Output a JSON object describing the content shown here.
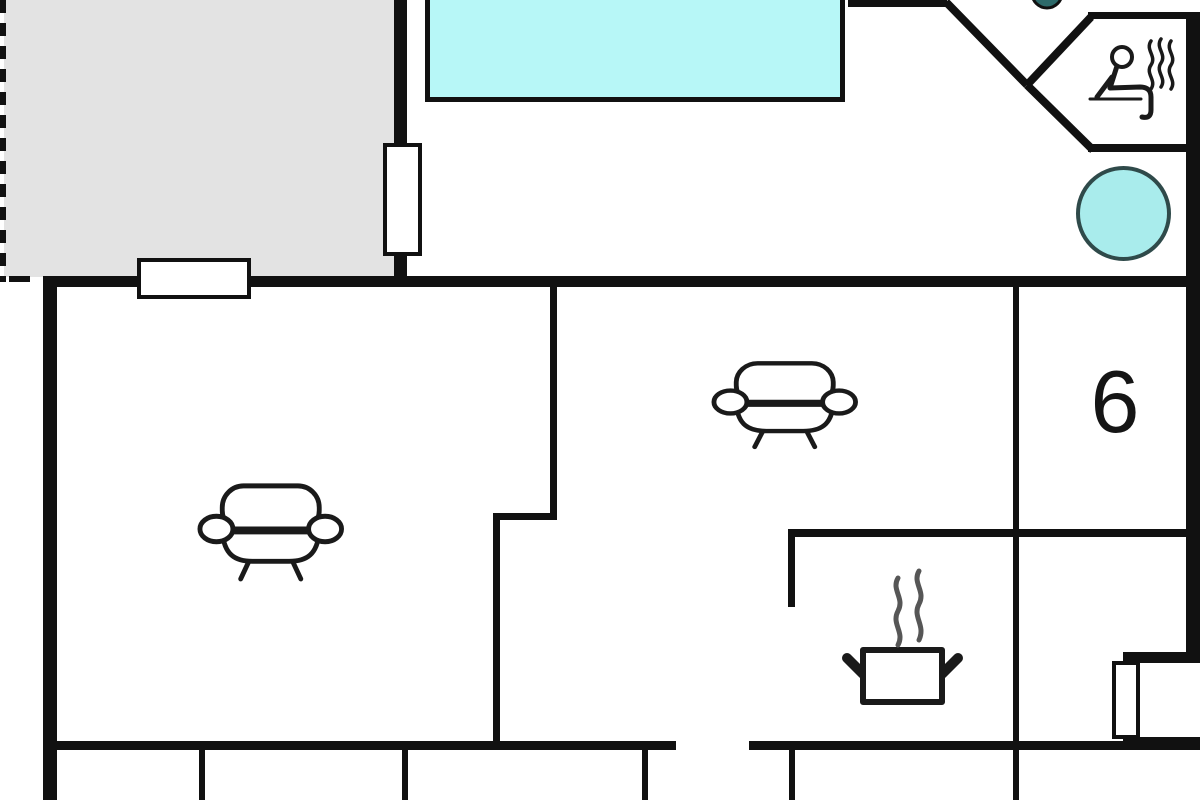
{
  "plan": {
    "room_number_label": "6"
  },
  "colors": {
    "wall": "#111111",
    "terrace": "#e3e3e3",
    "pool": "#b7f7f7",
    "hot_tub": "#a9ecec",
    "hot_tub_border": "#2f4a4a",
    "teal_accent": "#2d6a6a",
    "steam": "#565656",
    "icon_stroke": "#1a1a1a",
    "background": "#ffffff"
  },
  "icons": {
    "sauna": "person-sitting-in-sauna-with-steam",
    "pool": "swimming-pool",
    "hot_tub": "hot-tub-circle",
    "sofa": "sofa-top-view",
    "stove": "steaming-cooking-pot",
    "window": "window-in-wall",
    "accent_dot": "round-table-partial"
  }
}
